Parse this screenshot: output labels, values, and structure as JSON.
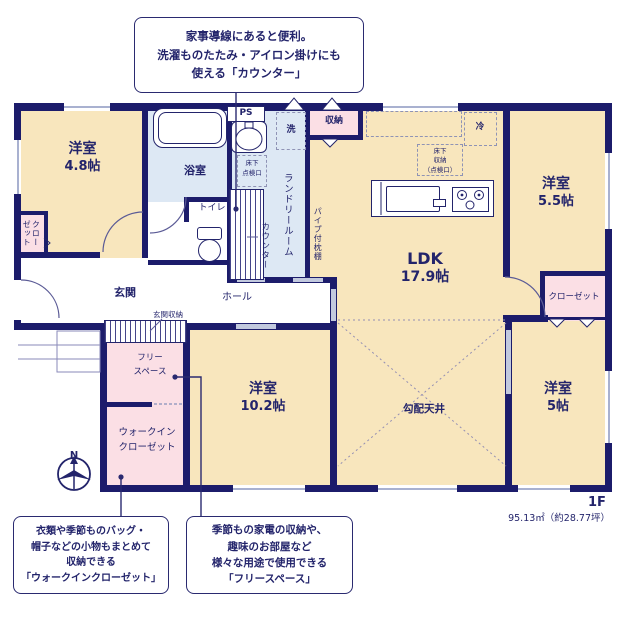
{
  "callouts": {
    "counter": {
      "lines": [
        "家事導線にあると便利。",
        "洗濯ものたたみ・アイロン掛けにも",
        "使える「カウンター」"
      ]
    },
    "walk_in_closet": {
      "lines": [
        "衣類や季節ものバッグ・",
        "帽子などの小物もまとめて",
        "収納できる",
        "「ウォークインクローゼット」"
      ]
    },
    "free_space": {
      "lines": [
        "季節もの家電の収納や、",
        "趣味のお部屋など",
        "様々な用途で使用できる",
        "「フリースペース」"
      ]
    }
  },
  "rooms": {
    "bedroom_48": {
      "name": "洋室",
      "size": "4.8帖"
    },
    "bedroom_55": {
      "name": "洋室",
      "size": "5.5帖"
    },
    "bedroom_102": {
      "name": "洋室",
      "size": "10.2帖"
    },
    "bedroom_5": {
      "name": "洋室",
      "size": "5帖"
    },
    "ldk": {
      "name": "LDK",
      "size": "17.9帖"
    },
    "bathroom": "浴室",
    "toilet": "トイレ",
    "entrance": "玄関",
    "entrance_storage": "玄関収納",
    "hall": "ホール",
    "laundry_room": "ランドリールーム",
    "counter": "カウンター",
    "pipe_shelf": "パイプ付枕棚",
    "free_space": {
      "line1": "フリー",
      "line2": "スペース"
    },
    "walk_in_closet": {
      "line1": "ウォークイン",
      "line2": "クローゼット"
    },
    "sloped_ceiling": "勾配天井",
    "closet": "クローゼット",
    "closet_small": "クローゼット",
    "storage": "収納",
    "ps": "PS",
    "washer": "洗",
    "refrigerator": "冷",
    "underfloor_access": {
      "line1": "床下",
      "line2": "点検口"
    },
    "underfloor_storage": {
      "line1": "床下",
      "line2": "収納",
      "line3": "（点検口）"
    }
  },
  "floor": {
    "label": "1F",
    "area": "95.13㎡（約28.77坪）"
  },
  "compass": {
    "north": "N"
  },
  "colors": {
    "wall": "#1c1c6b",
    "room_cream": "#f8e6bd",
    "room_pink": "#fbdfe5",
    "room_blue": "#dde8f4",
    "text": "#23246b"
  }
}
